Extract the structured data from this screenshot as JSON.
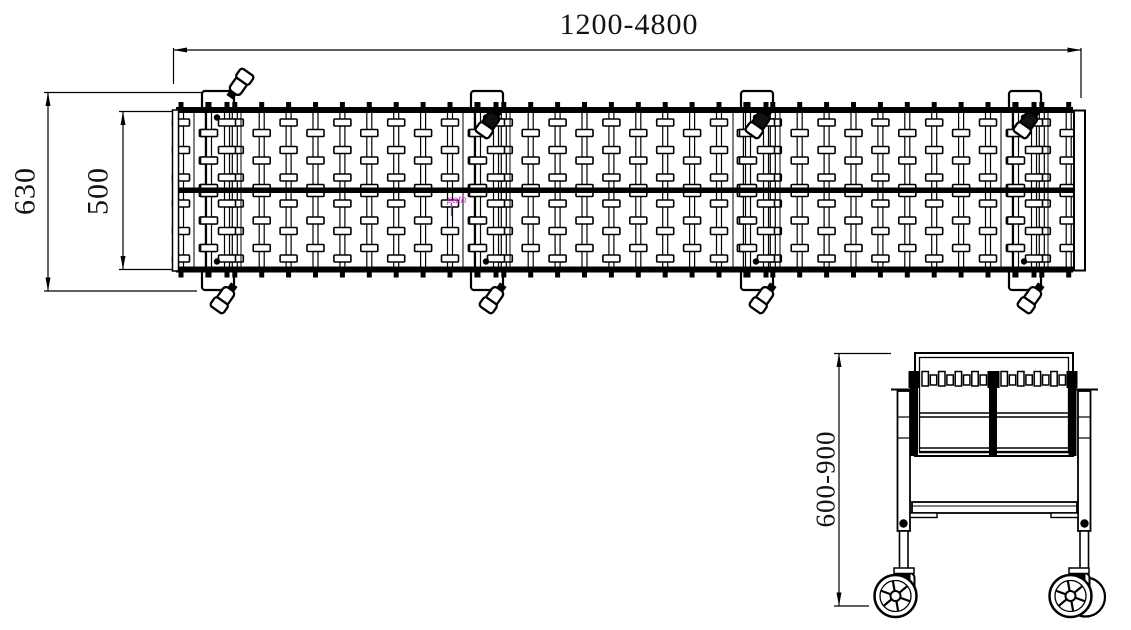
{
  "page": {
    "background": "#ffffff",
    "line_color": "#000000",
    "text_color": "#141414"
  },
  "top_view": {
    "length_dim": "1200-4800",
    "overall_width_dim": "630",
    "bed_width_dim": "500",
    "artifact": {
      "label": "path",
      "color": "#e03ce0",
      "pointer_color": "#5055d2"
    }
  },
  "end_view": {
    "height_dim": "600-900"
  }
}
